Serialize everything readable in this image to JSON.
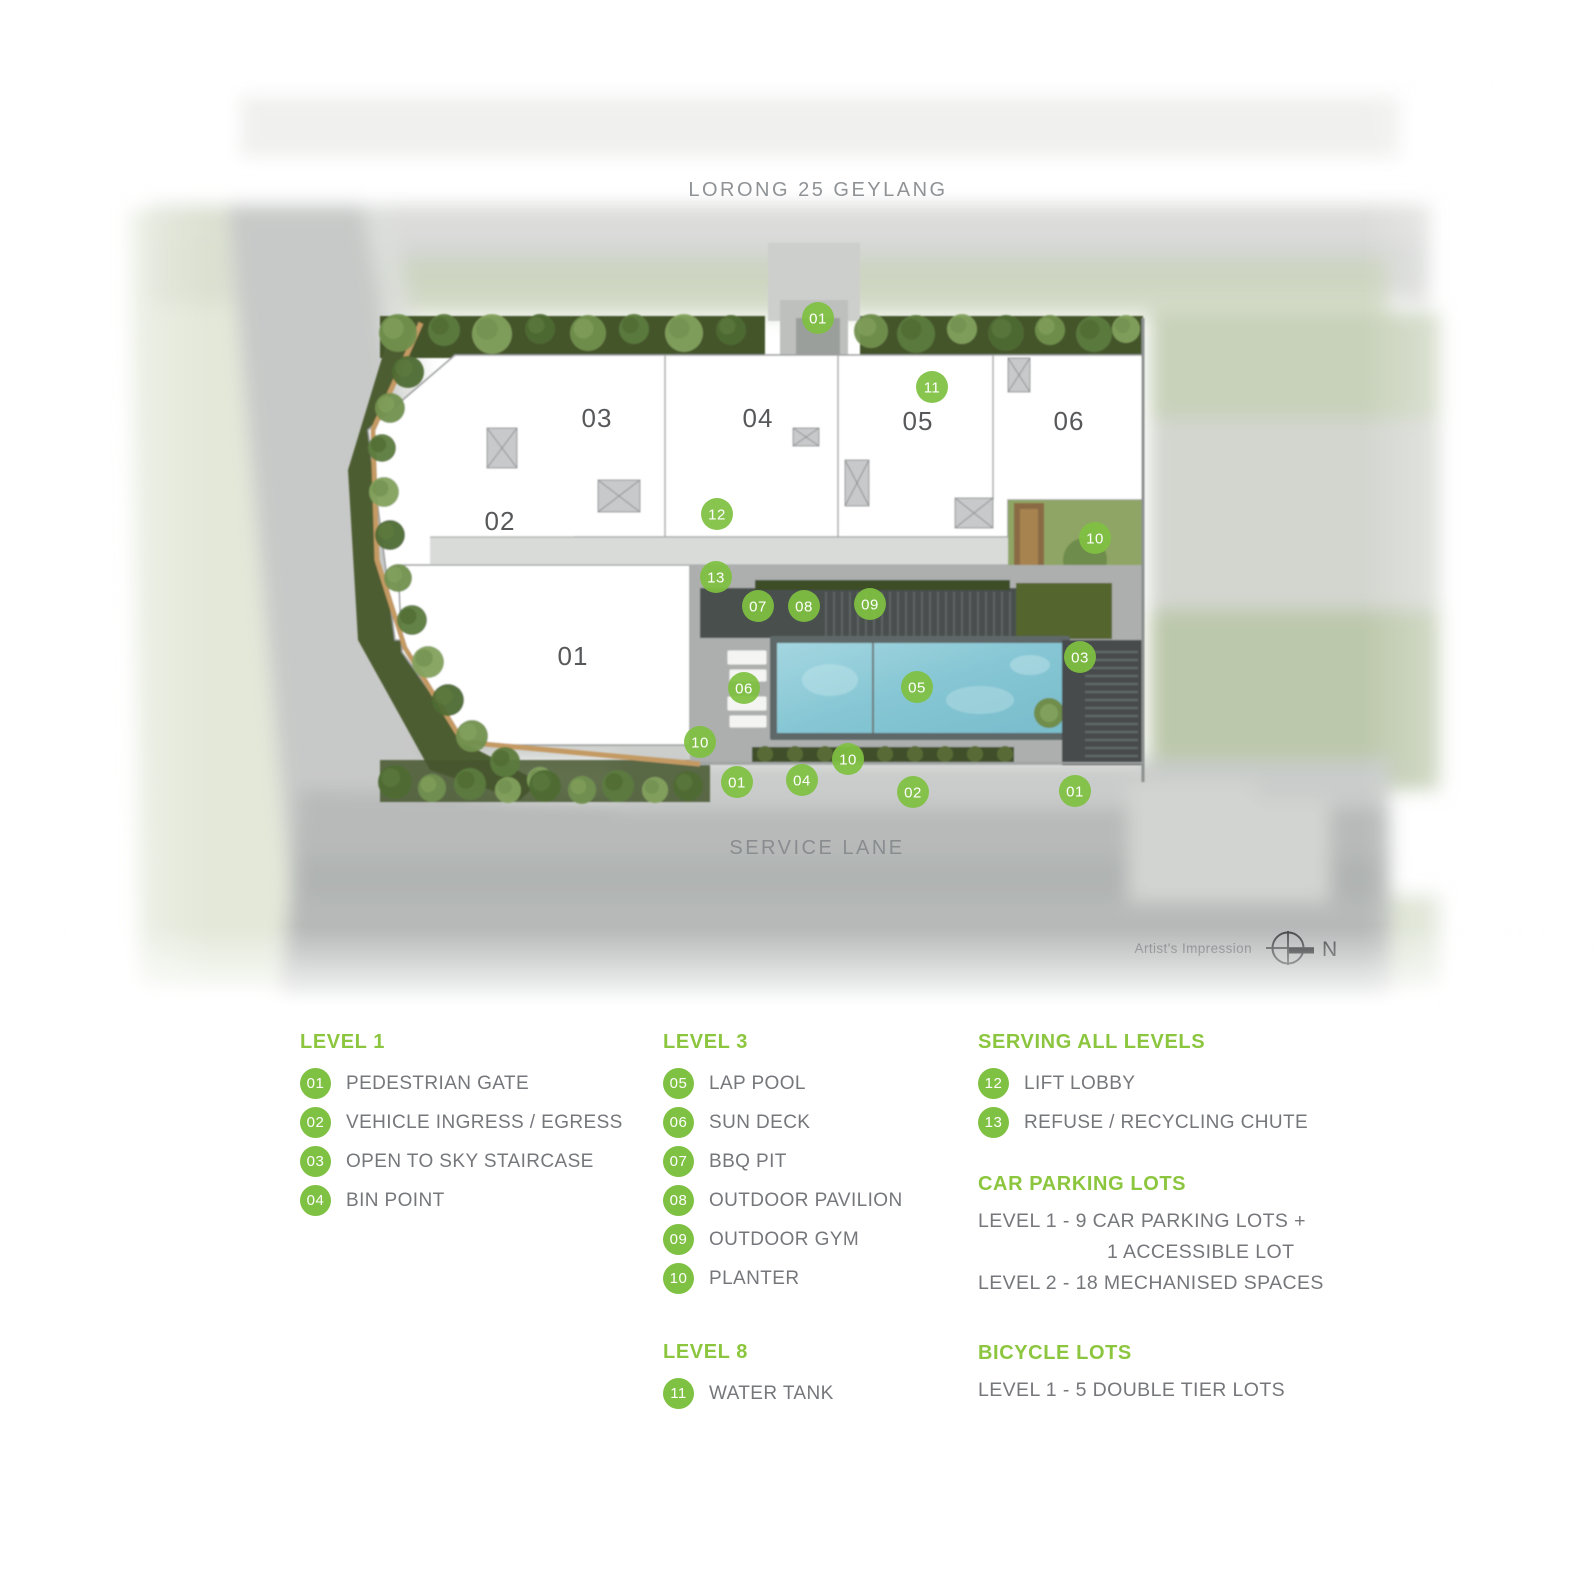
{
  "plan": {
    "top_road_label": "LORONG 25 GEYLANG",
    "bottom_road_label": "SERVICE LANE",
    "artist_impression": "Artist's Impression",
    "north_label": "N",
    "buildings": [
      {
        "label": "01",
        "x": 573,
        "y": 656
      },
      {
        "label": "02",
        "x": 500,
        "y": 521
      },
      {
        "label": "03",
        "x": 597,
        "y": 418
      },
      {
        "label": "04",
        "x": 758,
        "y": 418
      },
      {
        "label": "05",
        "x": 918,
        "y": 421
      },
      {
        "label": "06",
        "x": 1069,
        "y": 421
      }
    ],
    "markers": [
      {
        "n": "01",
        "x": 818,
        "y": 318
      },
      {
        "n": "11",
        "x": 932,
        "y": 387
      },
      {
        "n": "12",
        "x": 717,
        "y": 514
      },
      {
        "n": "13",
        "x": 716,
        "y": 577
      },
      {
        "n": "07",
        "x": 758,
        "y": 606
      },
      {
        "n": "08",
        "x": 804,
        "y": 606
      },
      {
        "n": "09",
        "x": 870,
        "y": 604
      },
      {
        "n": "10",
        "x": 1095,
        "y": 538
      },
      {
        "n": "03",
        "x": 1080,
        "y": 657
      },
      {
        "n": "06",
        "x": 744,
        "y": 688
      },
      {
        "n": "05",
        "x": 917,
        "y": 687
      },
      {
        "n": "10",
        "x": 700,
        "y": 742
      },
      {
        "n": "10",
        "x": 848,
        "y": 759
      },
      {
        "n": "01",
        "x": 737,
        "y": 782
      },
      {
        "n": "04",
        "x": 802,
        "y": 780
      },
      {
        "n": "02",
        "x": 913,
        "y": 792
      },
      {
        "n": "01",
        "x": 1075,
        "y": 791
      }
    ]
  },
  "legend": {
    "sections": [
      {
        "col": 0,
        "title": "LEVEL 1",
        "items": [
          {
            "n": "01",
            "label": "PEDESTRIAN GATE"
          },
          {
            "n": "02",
            "label": "VEHICLE INGRESS / EGRESS"
          },
          {
            "n": "03",
            "label": "OPEN TO SKY STAIRCASE"
          },
          {
            "n": "04",
            "label": "BIN POINT"
          }
        ]
      },
      {
        "col": 1,
        "title": "LEVEL 3",
        "items": [
          {
            "n": "05",
            "label": "LAP POOL"
          },
          {
            "n": "06",
            "label": "SUN DECK"
          },
          {
            "n": "07",
            "label": "BBQ PIT"
          },
          {
            "n": "08",
            "label": "OUTDOOR PAVILION"
          },
          {
            "n": "09",
            "label": "OUTDOOR GYM"
          },
          {
            "n": "10",
            "label": "PLANTER"
          }
        ]
      },
      {
        "col": 1,
        "title": "LEVEL 8",
        "gap": 42,
        "items": [
          {
            "n": "11",
            "label": "WATER TANK"
          }
        ]
      },
      {
        "col": 2,
        "title": "SERVING ALL LEVELS",
        "items": [
          {
            "n": "12",
            "label": "LIFT LOBBY"
          },
          {
            "n": "13",
            "label": "REFUSE / RECYCLING CHUTE"
          }
        ]
      },
      {
        "col": 2,
        "title": "CAR PARKING LOTS",
        "gap": 30,
        "lines": [
          {
            "text": "LEVEL 1 - 9 CAR PARKING LOTS +",
            "indent": false
          },
          {
            "text": "1 ACCESSIBLE LOT",
            "indent": true
          },
          {
            "text": "LEVEL 2 - 18 MECHANISED SPACES",
            "indent": false
          }
        ]
      },
      {
        "col": 2,
        "title": "BICYCLE LOTS",
        "gap": 42,
        "lines": [
          {
            "text": "LEVEL 1 - 5 DOUBLE TIER LOTS",
            "indent": false
          }
        ]
      }
    ]
  },
  "colors": {
    "marker_green": "#7FC142",
    "header_green": "#8CC63F",
    "legend_text": "#75777B",
    "road_label_gray": "#8F9396",
    "building_label_gray": "#57585A",
    "pool_blue": "#8FCBD8"
  }
}
